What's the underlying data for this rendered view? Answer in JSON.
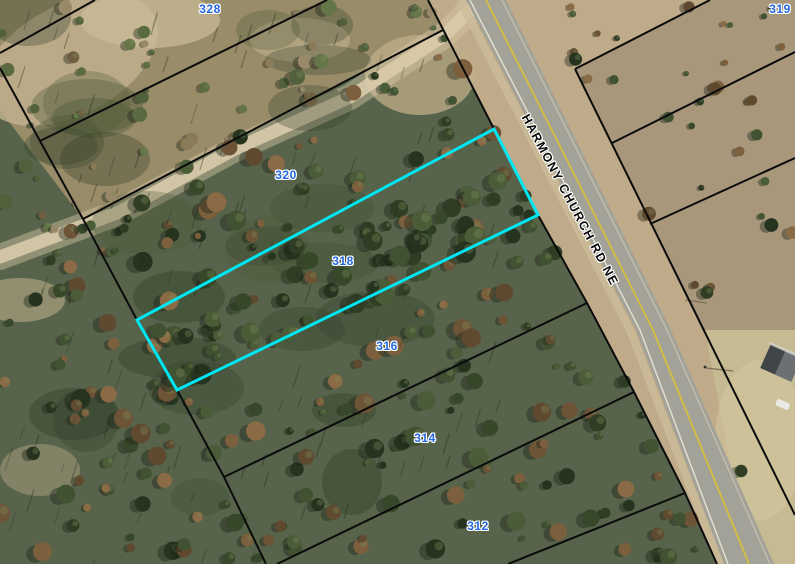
{
  "map": {
    "type": "parcel-aerial-map",
    "road_label": "HARMONY CHURCH RD NE",
    "road_label_angle_deg": 62,
    "selected_parcel": "318",
    "highlight_color": "#00E6F2",
    "boundary_color": "#0B0B0B",
    "parcel_label_color": "#2368E0",
    "road_centerline_color": "#D6BF3F",
    "parcel_labels": [
      {
        "id": "328",
        "x": 210,
        "y": 9
      },
      {
        "id": "319",
        "x": 780,
        "y": 9
      },
      {
        "id": "320",
        "x": 286,
        "y": 175
      },
      {
        "id": "318",
        "x": 343,
        "y": 261
      },
      {
        "id": "316",
        "x": 387,
        "y": 346
      },
      {
        "id": "314",
        "x": 425,
        "y": 438
      },
      {
        "id": "312",
        "x": 478,
        "y": 526
      }
    ],
    "selected_parcel_outline_px": [
      [
        137,
        320
      ],
      [
        494,
        129
      ],
      [
        538,
        215
      ],
      [
        177,
        390
      ]
    ]
  }
}
